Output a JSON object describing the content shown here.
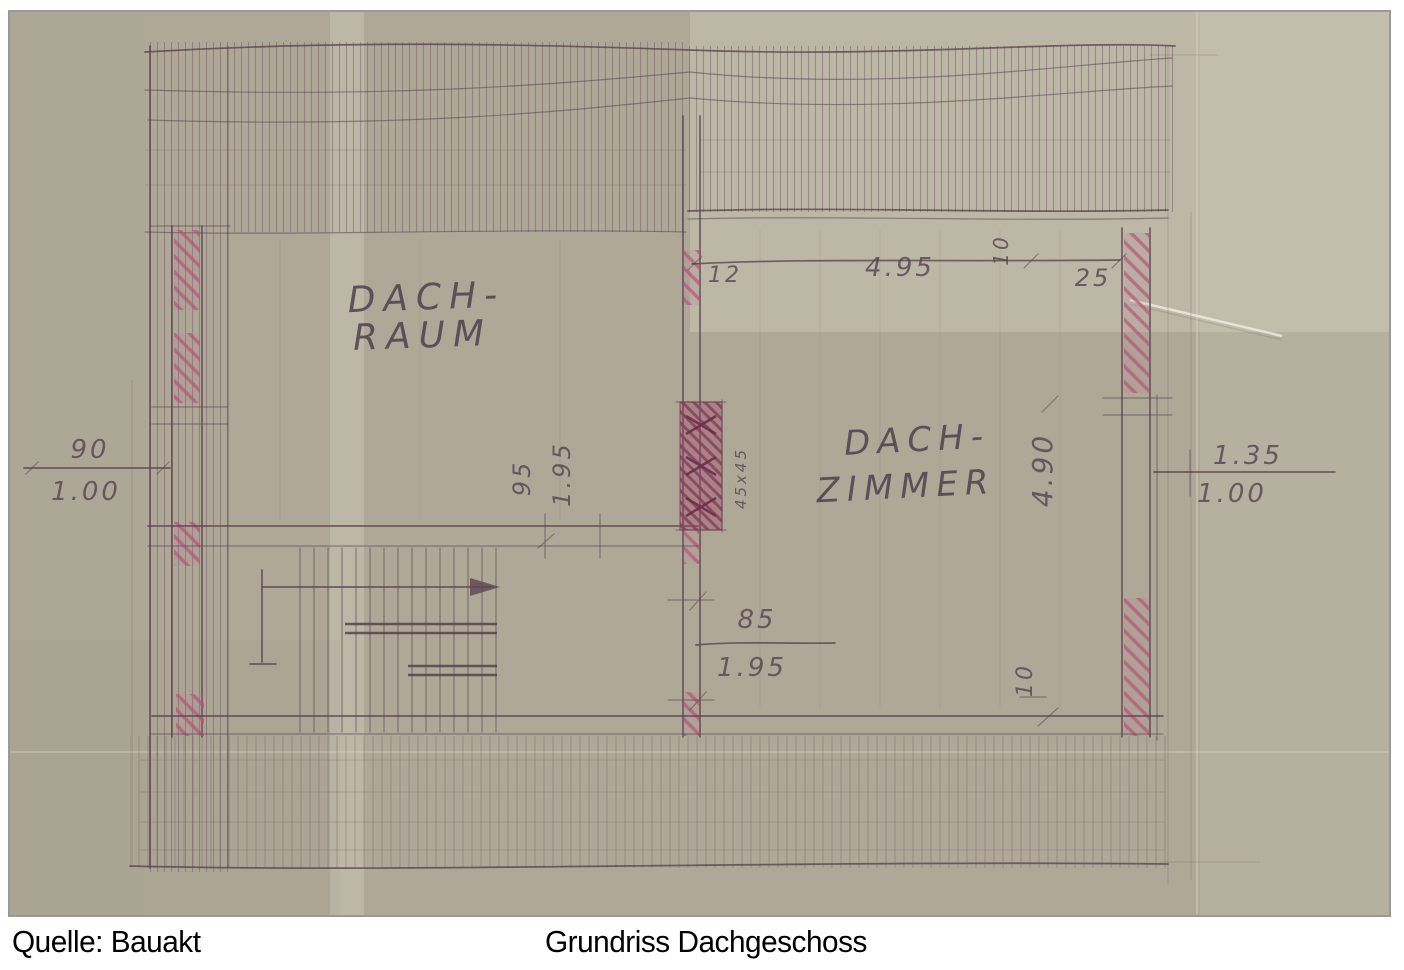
{
  "caption": {
    "source": "Quelle: Bauakt",
    "title": "Grundriss Dachgeschoss"
  },
  "plan": {
    "room_labels": {
      "dachraum_line1": "DACH-",
      "dachraum_line2": "RAUM",
      "dachzimmer_line1": "DACH-",
      "dachzimmer_line2": "ZIMMER"
    },
    "dimensions": {
      "left_opening_width": "90",
      "left_opening_height": "1.00",
      "right_opening_width": "1.35",
      "right_opening_height": "1.00",
      "top_offset": "12",
      "top_room_width": "4.95",
      "top_tick": "10",
      "top_wall_thickness": "25",
      "mid_door_width": "95",
      "mid_door_height": "1.95",
      "right_door_width": "85",
      "right_door_height": "1.95",
      "room_depth": "4.90",
      "bottom_tick": "10",
      "chimney_size": "45x45"
    },
    "colors": {
      "paper": "#afa897",
      "pencil": "#5a4550",
      "wall_hatch_pink": "#b2547a",
      "chimney_dark": "#8e3d5c",
      "photo_frame": "#98999b",
      "caption_text": "#000000"
    }
  }
}
